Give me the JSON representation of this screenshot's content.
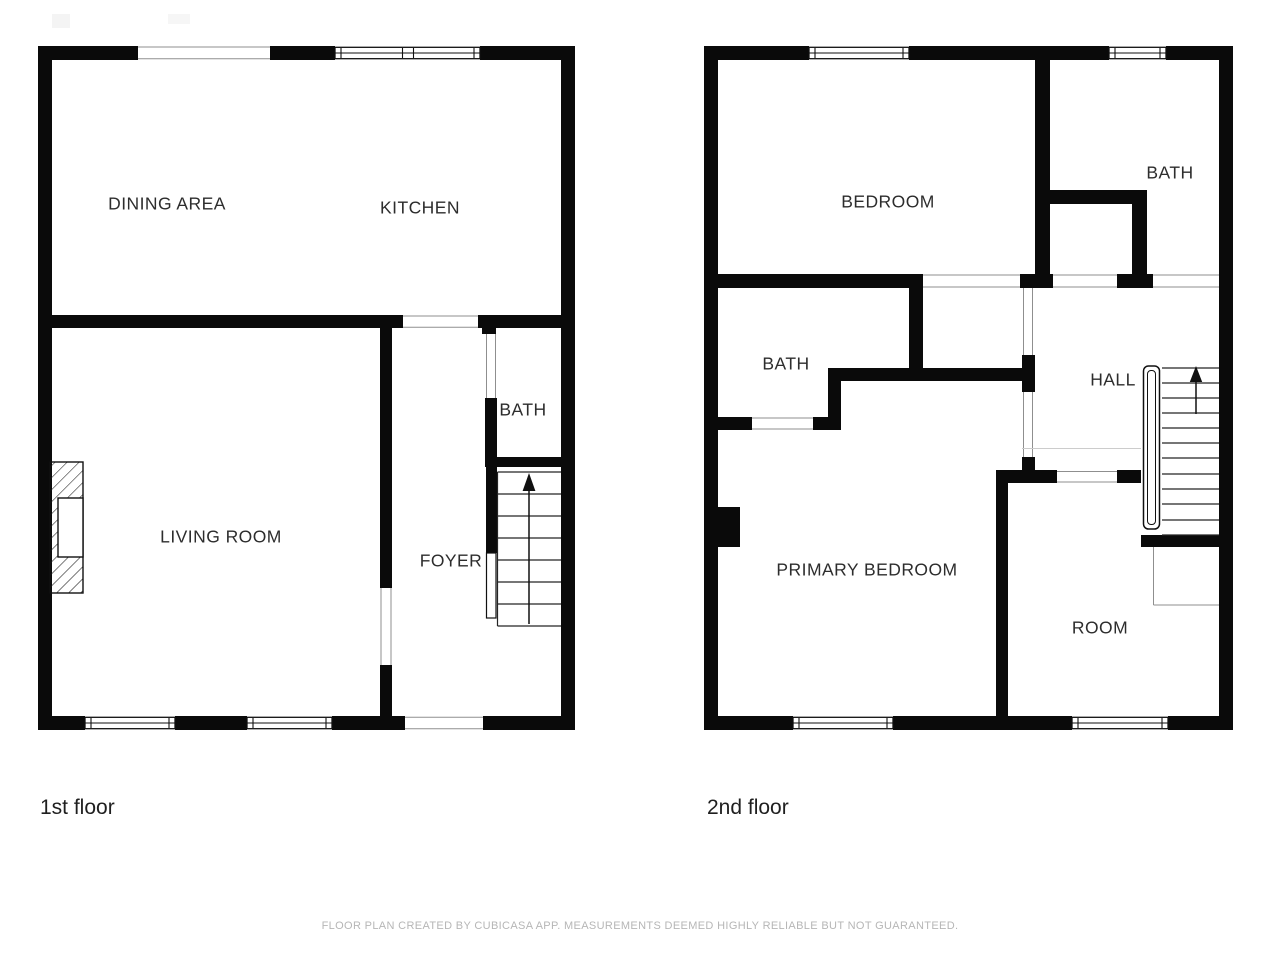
{
  "colors": {
    "wall": "#0a0a0a",
    "room_label": "#2d2d2d",
    "floor_label": "#1f1f1f",
    "footer_text": "#b6b6b6"
  },
  "floor1": {
    "label": "1st floor",
    "rooms": {
      "dining_area": "DINING AREA",
      "kitchen": "KITCHEN",
      "bath": "BATH",
      "living_room": "LIVING ROOM",
      "foyer": "FOYER"
    }
  },
  "floor2": {
    "label": "2nd floor",
    "rooms": {
      "bedroom": "BEDROOM",
      "bath_right": "BATH",
      "bath_left": "BATH",
      "hall": "HALL",
      "primary_bedroom": "PRIMARY BEDROOM",
      "room": "ROOM"
    }
  },
  "footer": {
    "disclaimer": "FLOOR PLAN CREATED BY CUBICASA APP. MEASUREMENTS DEEMED HIGHLY RELIABLE BUT NOT GUARANTEED."
  }
}
